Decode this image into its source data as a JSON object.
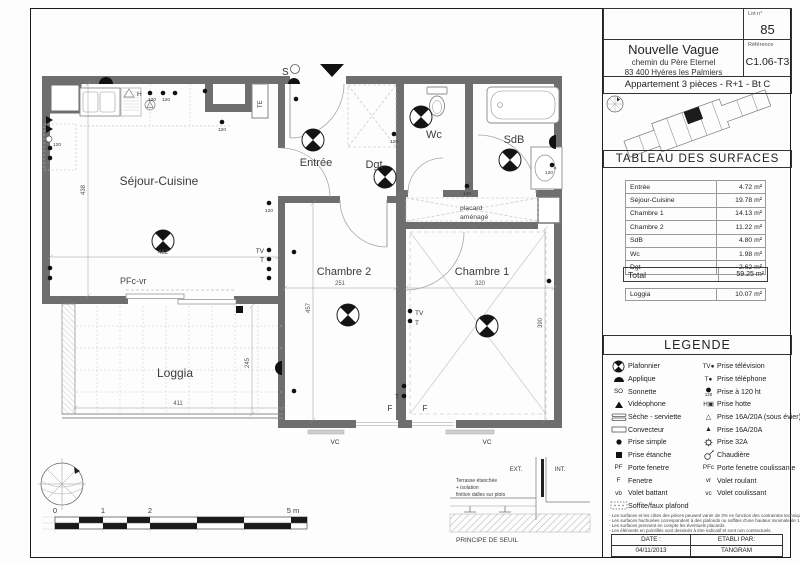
{
  "title_block": {
    "lot_label": "Lot n°",
    "lot_number": "85",
    "reference_label": "Référence",
    "reference": "C1.06-T3",
    "project_name": "Nouvelle Vague",
    "address_line1": "chemin du Père Eternel",
    "address_line2": "83 400 Hyères les Palmiers",
    "apartment_info": "Appartement 3 pièces - R+1 - Bt C"
  },
  "surface_table": {
    "title": "TABLEAU DES SURFACES",
    "rows": [
      {
        "label": "Entrée",
        "value": "4.72 m²"
      },
      {
        "label": "Séjour-Cuisine",
        "value": "19.78 m²"
      },
      {
        "label": "Chambre 1",
        "value": "14.13 m²"
      },
      {
        "label": "Chambre 2",
        "value": "11.22 m²"
      },
      {
        "label": "SdB",
        "value": "4.80 m²"
      },
      {
        "label": "Wc",
        "value": "1.98 m²"
      },
      {
        "label": "Dgt",
        "value": "2.62 m²"
      }
    ],
    "total": {
      "label": "Total",
      "value": "59.25 m²"
    },
    "loggia": {
      "label": "Loggia",
      "value": "10.07 m²"
    }
  },
  "legend": {
    "title": "LEGENDE",
    "left": [
      {
        "icon": "plafonnier",
        "label": "Plafonnier"
      },
      {
        "icon": "applique",
        "label": "Applique"
      },
      {
        "symbol": "SO",
        "label": "Sonnette"
      },
      {
        "icon": "videophone",
        "label": "Vidéophone"
      },
      {
        "icon": "seche-serviette",
        "label": "Sèche - serviette"
      },
      {
        "icon": "convecteur",
        "label": "Convecteur"
      },
      {
        "icon": "prise-simple",
        "label": "Prise simple"
      },
      {
        "icon": "prise-etanche",
        "label": "Prise étanche"
      },
      {
        "symbol": "PF",
        "label": "Porte fenetre"
      },
      {
        "symbol": "F",
        "label": "Fenetre"
      },
      {
        "symbol": "vb",
        "label": "Volet battant"
      },
      {
        "icon": "soffite",
        "label": "Soffite/faux plafond"
      }
    ],
    "right": [
      {
        "symbol": "TV●",
        "label": "Prise télévision"
      },
      {
        "symbol": "T●",
        "label": "Prise téléphone"
      },
      {
        "icon": "prise-120",
        "label": "Prise à 120 ht"
      },
      {
        "symbol": "H▣",
        "label": "Prise hotte"
      },
      {
        "symbol": "△",
        "label": "Prise 16A/20A (sous évier)"
      },
      {
        "symbol": "▲",
        "label": "Prise 16A/20A"
      },
      {
        "icon": "prise-32a",
        "label": "Prise 32A"
      },
      {
        "icon": "chaudiere",
        "label": "Chaudière"
      },
      {
        "symbol": "PFc",
        "label": "Porte fenetre coulissante"
      },
      {
        "symbol": "vr",
        "label": "Volet roulant"
      },
      {
        "symbol": "vc",
        "label": "Volet coulissant"
      }
    ],
    "notes": [
      "- Les surfaces et les côtes des pièces peuvent varier de 3% en fonction des contraintes techniques",
      "- Les surfaces hachurées correspondent à des plafonds ou soffites d'une hauteur minimale de 1.45m",
      "- Les surfaces prennent en compte les éventuels placards.",
      "- Les éléments en pointillés sont dessinés à titre indicatif et sont non contractuels."
    ]
  },
  "footer": {
    "date_label": "DATE :",
    "date": "04/11/2013",
    "etabli_label": "ETABLI PAR:",
    "etabli": "TANGRAM"
  },
  "plan": {
    "rooms": {
      "sejour": "Séjour-Cuisine",
      "entree": "Entrée",
      "dgt": "Dgt",
      "wc": "Wc",
      "sdb": "SdB",
      "chambre2": "Chambre 2",
      "chambre1": "Chambre 1",
      "loggia": "Loggia",
      "placard_l1": "placard",
      "placard_l2": "aménagé"
    },
    "dims": {
      "sejour_w": "482",
      "sejour_h": "438",
      "chambre2_w": "251",
      "chambre2_h": "457",
      "chambre1_w": "320",
      "chambre1_h": "390",
      "loggia_w": "411",
      "loggia_h": "245"
    },
    "tags": {
      "s": "S",
      "te": "TE",
      "pfc_vr": "PFc-vr",
      "tv": "TV",
      "t": "T",
      "f": "F",
      "vc": "VC",
      "h": "H",
      "x120": "120"
    },
    "scalebar": {
      "t0": "0",
      "t1": "1",
      "t2": "2",
      "t5": "5 m"
    },
    "seuil": {
      "ext": "EXT.",
      "int": "INT.",
      "l1": "Terrasse étanchée",
      "l2": "+ isolation",
      "l3": "finition dalles sur plots",
      "title": "PRINCIPE DE SEUIL"
    }
  }
}
